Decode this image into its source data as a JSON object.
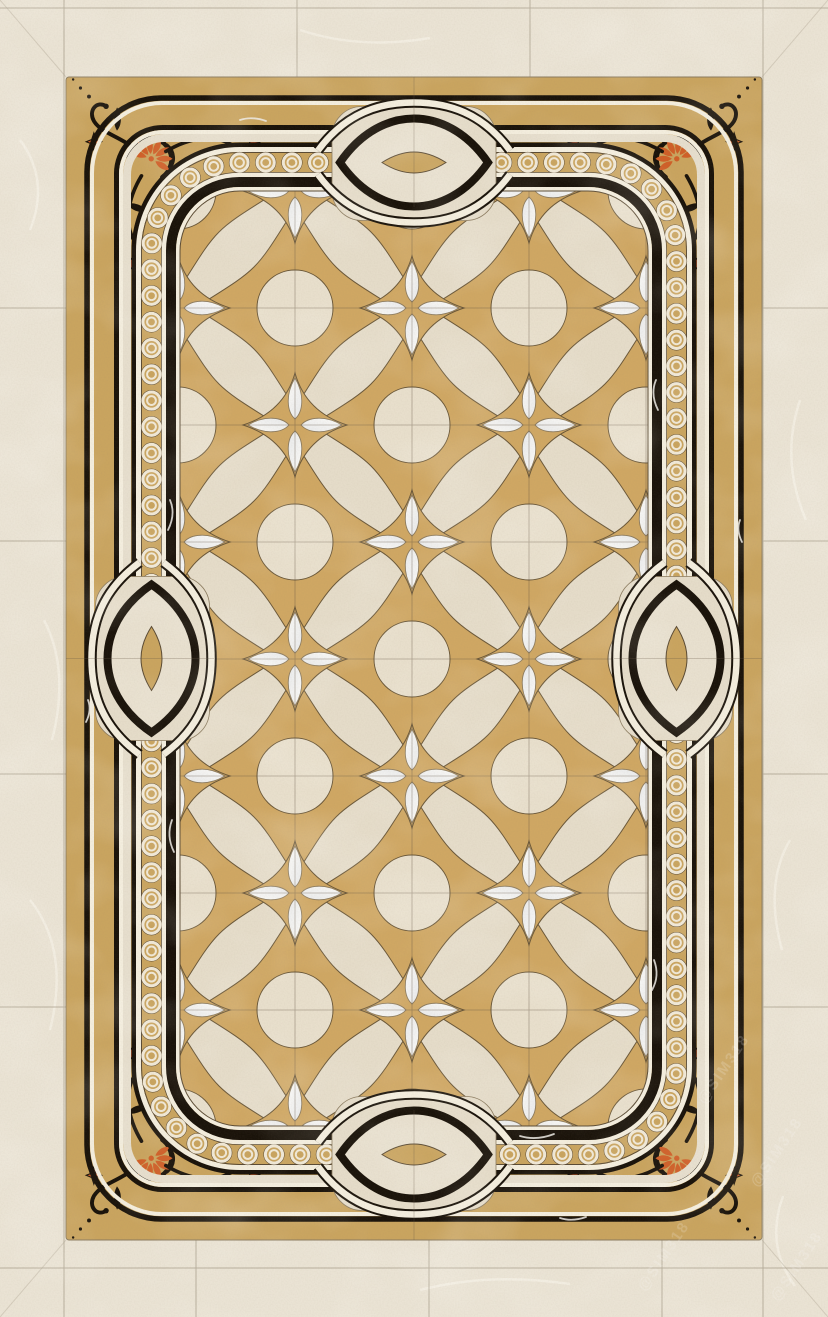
{
  "watermark": {
    "text": "@SIM318"
  },
  "colors": {
    "marble_bg": "#eae3d4",
    "marble_vein": "#f4efe3",
    "gold": "#c9a45f",
    "field_gold": "#cfa763",
    "field_bg": "#e5dcc9",
    "disc_fill": "#e8dfcc",
    "white_marble": "#f5f3ee",
    "white_band": "#f3eddd",
    "black_marble": "#1a130a",
    "outline_dark": "#5a4a33",
    "orange_accent": "#cf5f28",
    "joint_line": "#a89e8b",
    "chain_ring": "#f0e8d6",
    "watermark_color": "#ffffff"
  },
  "composition": {
    "corner_ornaments": 4,
    "side_interlock_motifs": 4,
    "border_chain": "circle chain band",
    "field_motif": "quatrefoil circles with white four-petal flowers"
  }
}
